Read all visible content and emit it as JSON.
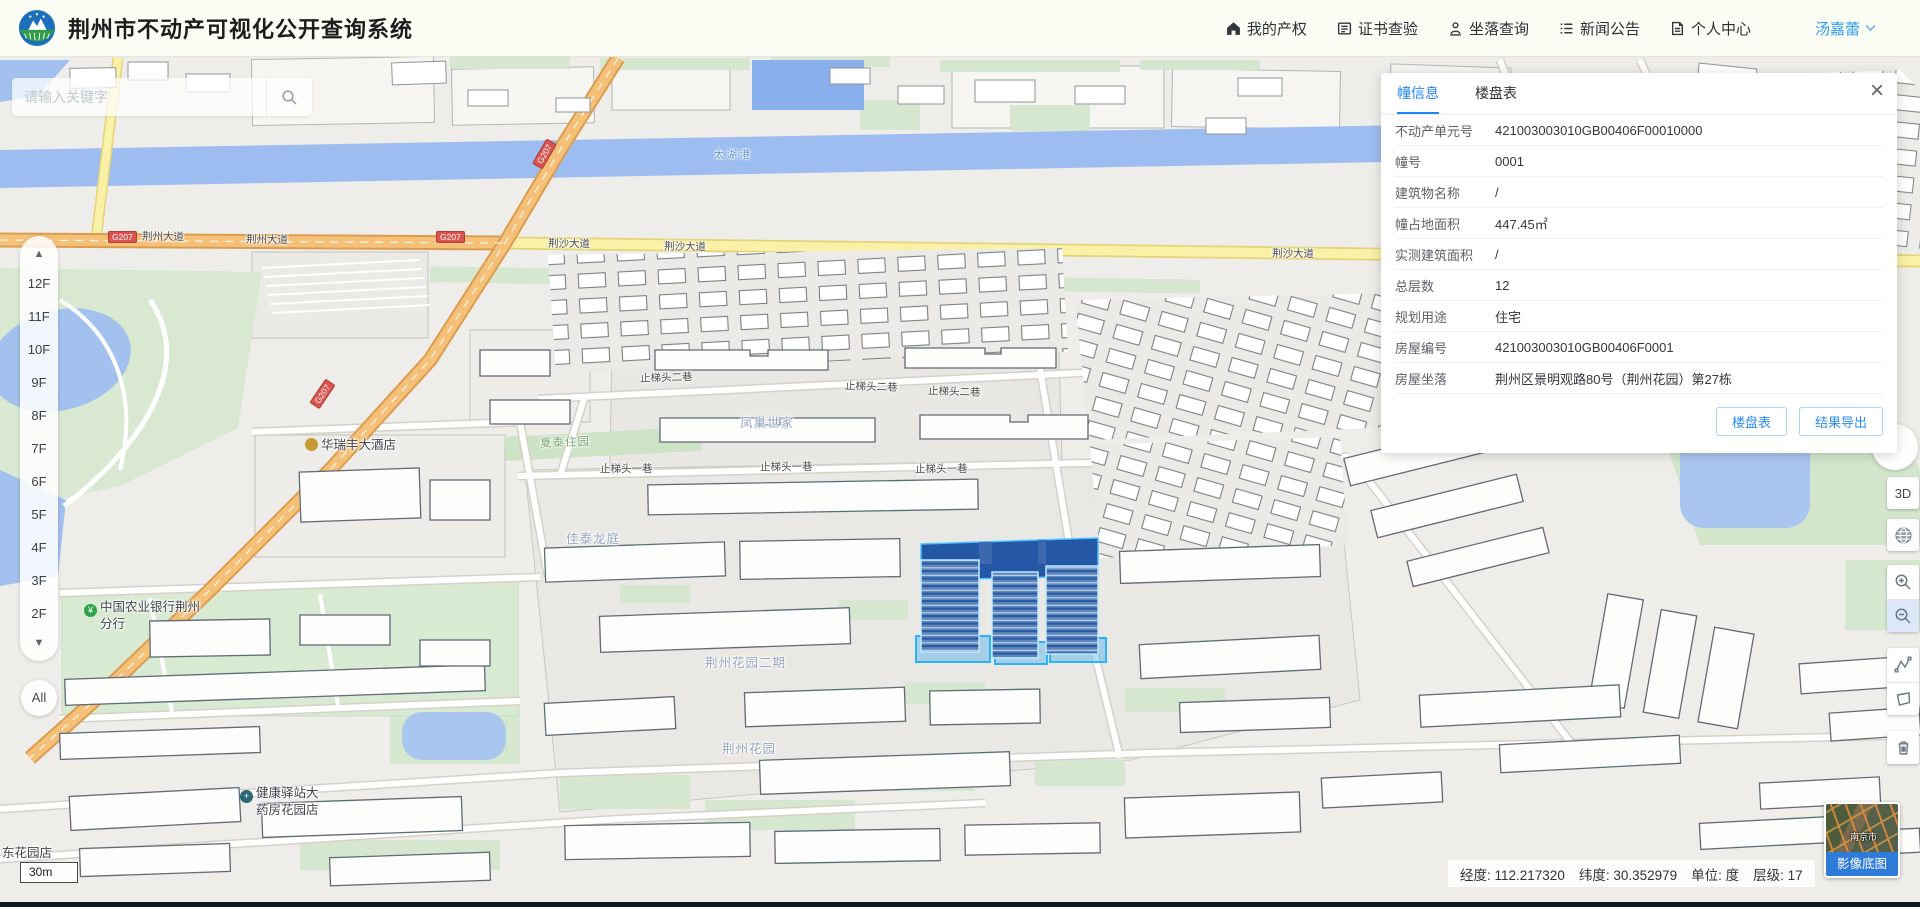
{
  "header": {
    "title": "荆州市不动产可视化公开查询系统",
    "nav": [
      {
        "label": "我的产权"
      },
      {
        "label": "证书查验"
      },
      {
        "label": "坐落查询"
      },
      {
        "label": "新闻公告"
      },
      {
        "label": "个人中心"
      }
    ],
    "username": "汤嘉蕾"
  },
  "search": {
    "placeholder": "请输入关键字"
  },
  "floors": {
    "items": [
      "12F",
      "11F",
      "10F",
      "9F",
      "8F",
      "7F",
      "6F",
      "5F",
      "4F",
      "3F",
      "2F"
    ],
    "all": "All"
  },
  "panel": {
    "tabs": {
      "building_info": "幢信息",
      "building_table": "楼盘表"
    },
    "rows": [
      {
        "label": "不动产单元号",
        "value": "421003003010GB00406F00010000"
      },
      {
        "label": "幢号",
        "value": "0001"
      },
      {
        "label": "建筑物名称",
        "value": "/"
      },
      {
        "label": "幢占地面积",
        "value": "447.45㎡"
      },
      {
        "label": "实测建筑面积",
        "value": "/"
      },
      {
        "label": "总层数",
        "value": "12"
      },
      {
        "label": "规划用途",
        "value": "住宅"
      },
      {
        "label": "房屋编号",
        "value": "421003003010GB00406F0001"
      },
      {
        "label": "房屋坐落",
        "value": "荆州区景明观路80号（荆州花园）第27栋"
      }
    ],
    "buttons": {
      "building_table": "楼盘表",
      "export": "结果导出"
    },
    "close": "×"
  },
  "tools": {
    "threed": "3D"
  },
  "statusbar": {
    "lon": "经度: 112.217320",
    "lat": "纬度: 30.352979",
    "unit": "单位: 度",
    "level": "层级: 17"
  },
  "basemap": {
    "label": "影像底图",
    "city": "南京市"
  },
  "scalebar": {
    "label": "30m"
  },
  "map": {
    "labels": {
      "alley2": "止梯头二巷",
      "alley1": "止梯头一巷",
      "jingsha": "荆沙大道",
      "jingzhou_ave": "荆州大道",
      "shield": "G207",
      "river": "太湖港",
      "fengchao": "凤巢世家",
      "xiatai": "夏泰住园",
      "jiatai": "佳泰龙庭",
      "jzgarden2": "荆州花园二期",
      "jzgarden": "荆州花园",
      "bank_l1": "中国农业银行荆州",
      "bank_l2": "分行",
      "bank_ico": "¥",
      "hotel": "华瑞丰大酒店",
      "pharmacy_l1": "健康驿站大",
      "pharmacy_l2": "药房花园店",
      "pharmacy_ico": "+",
      "shop_partial": "东花园店"
    }
  }
}
